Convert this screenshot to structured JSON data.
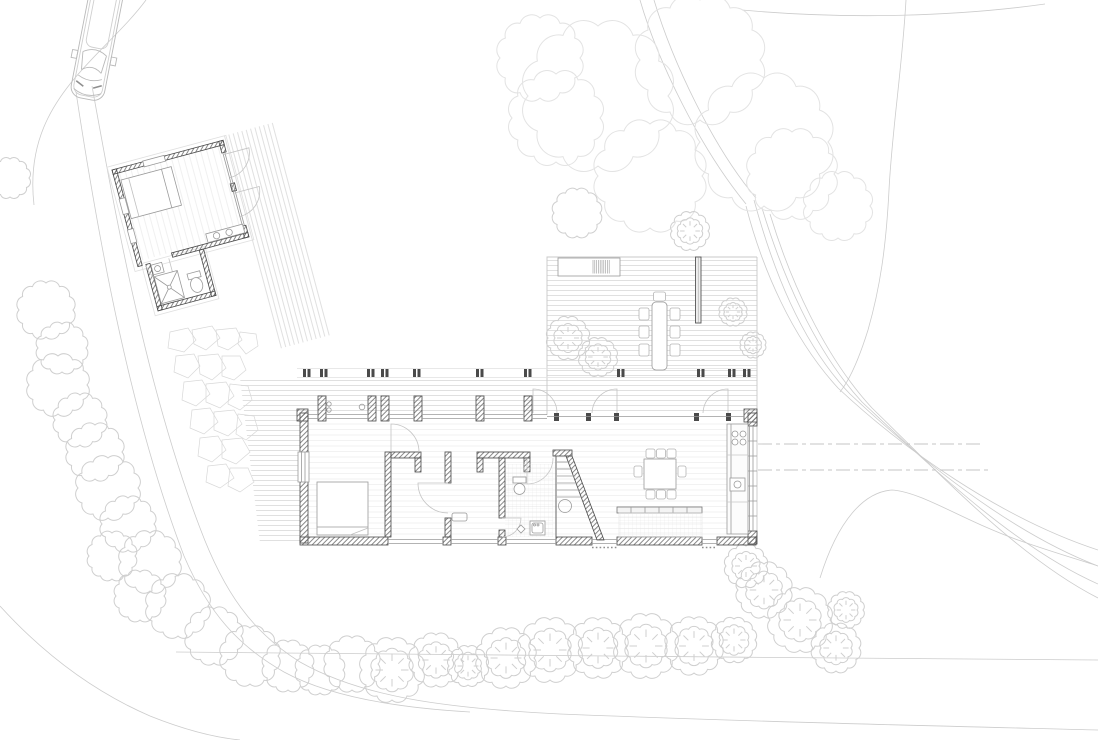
{
  "document": {
    "kind": "architectural-site-plan-line-drawing",
    "visible_text": ""
  },
  "colors": {
    "background": "#ffffff",
    "wall_line": "#4a4a4a",
    "wall_hatch": "#6a6a6a",
    "detail_line": "#9a9a9a",
    "deck_line": "#d8d8d8",
    "site_line": "#cccccc",
    "canopy_line": "#e3e3e3",
    "tree_line": "#cfcfcf",
    "floor_line": "#efefef",
    "car_line": "#b9b9b9"
  },
  "plan": {
    "site_elements": [
      "driveway-curve",
      "footpath",
      "contour-lines",
      "utility-dashed-lines",
      "stone-path",
      "hedge-row",
      "bottom-tree-row",
      "tree-canopy-cluster",
      "lawn"
    ],
    "vehicle": "car-top-view",
    "guest_house": {
      "rooms": [
        "studio-room",
        "bathroom"
      ],
      "fixtures": [
        "bed",
        "shower",
        "toilet",
        "sink",
        "vanity",
        "side-deck",
        "entry-doors"
      ]
    },
    "main_house": {
      "rooms": [
        "bedroom",
        "north-corridor",
        "second-room",
        "bathroom",
        "stair",
        "kitchen",
        "living-dining"
      ],
      "fixtures": [
        "bed",
        "window-seat",
        "toilet",
        "washer",
        "floor-drain",
        "stairs",
        "kitchen-counter",
        "cooktop",
        "kitchen-sink",
        "kitchen-island",
        "dining-table",
        "dining-chairs"
      ],
      "outdoor": [
        "north-porch",
        "large-deck",
        "outdoor-dining-set",
        "planter-bench",
        "grill",
        "privacy-wall",
        "roof-posts"
      ]
    }
  }
}
